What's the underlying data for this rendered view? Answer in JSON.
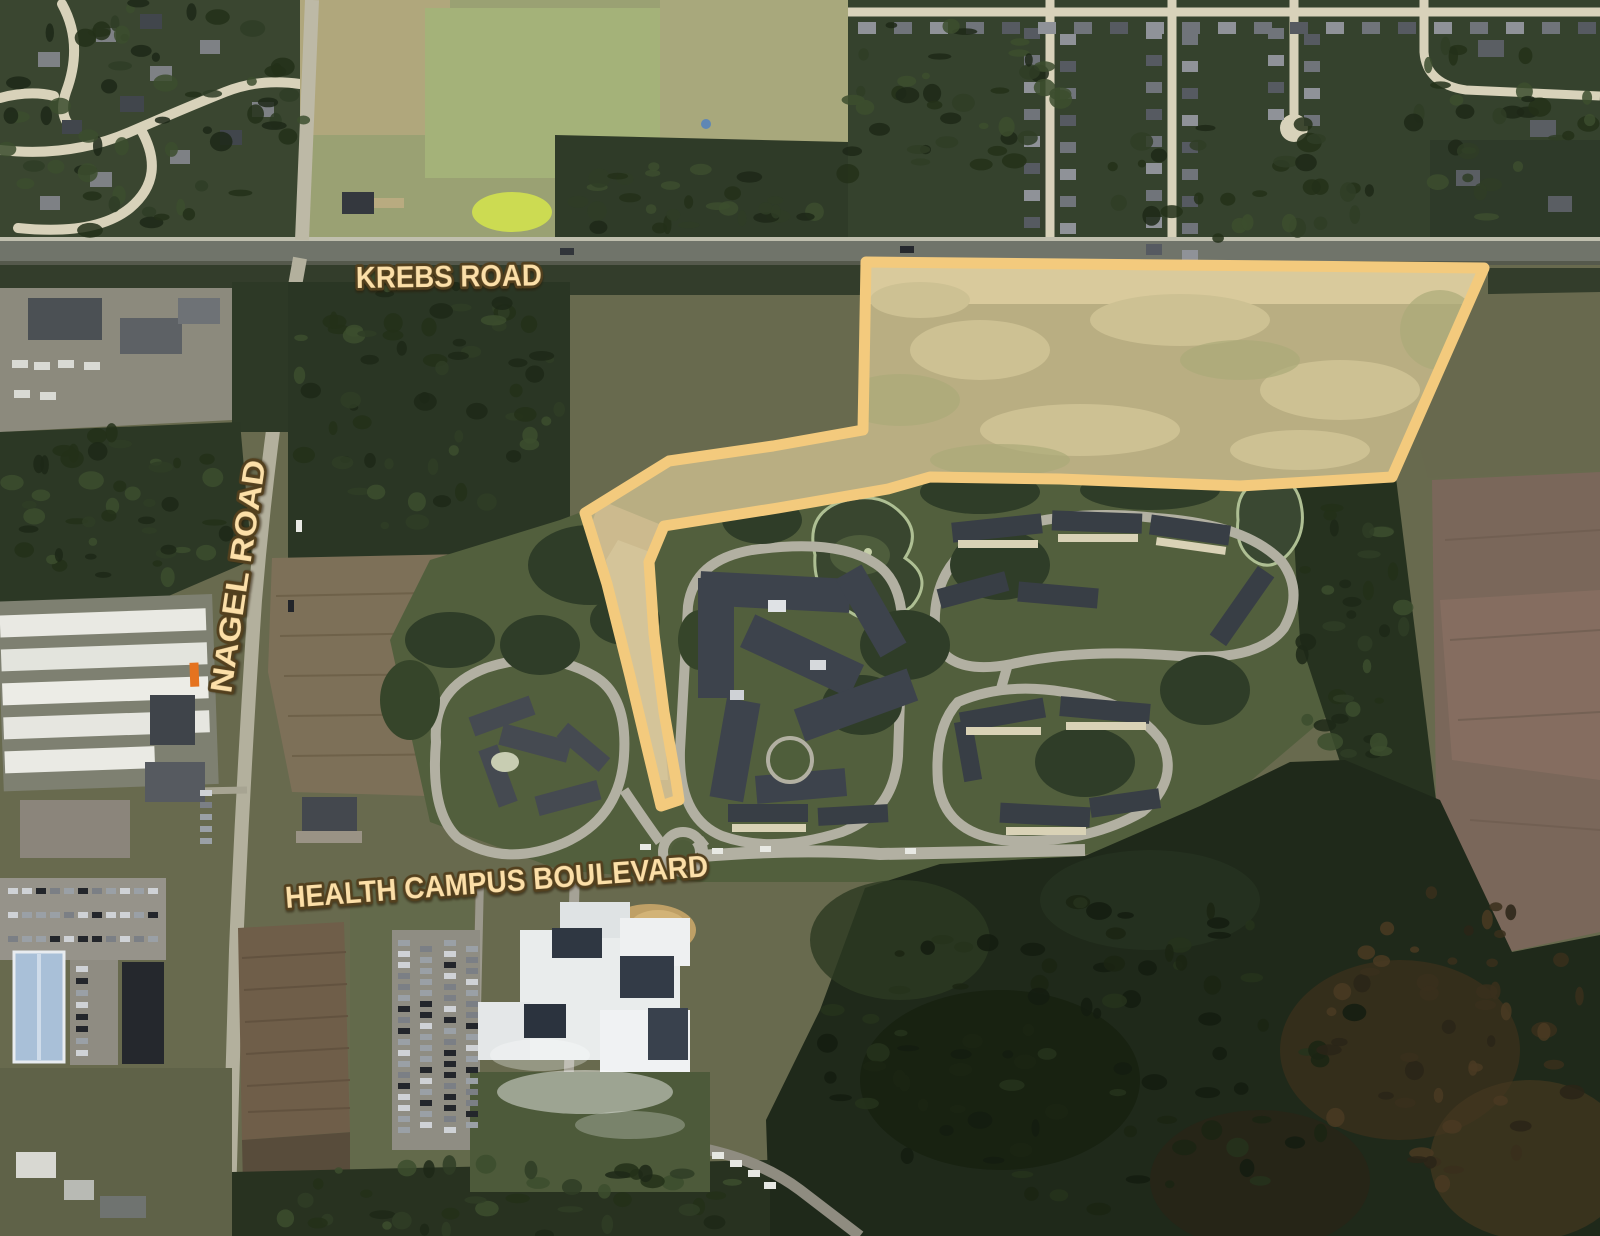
{
  "map_overlay": {
    "road_labels": [
      {
        "id": "krebs",
        "text": "KREBS ROAD"
      },
      {
        "id": "nagel",
        "text": "NAGEL ROAD"
      },
      {
        "id": "health_campus",
        "text": "HEALTH CAMPUS BOULEVARD"
      }
    ],
    "label_style": {
      "text_color": "#FCDFA8",
      "outline_color": "#53401E"
    },
    "highlighted_parcel": {
      "stroke_color": "#F3CA7D",
      "fill_color": "rgba(245,224,165,0.38)",
      "points": "866,262 1484,268 1392,477 1240,486 1060,479 930,477 888,489 778,508 664,526 649,562 654,634 664,712 676,780 679,800 661,806 648,752 630,676 607,584 585,513 669,461 773,446 863,430"
    }
  }
}
